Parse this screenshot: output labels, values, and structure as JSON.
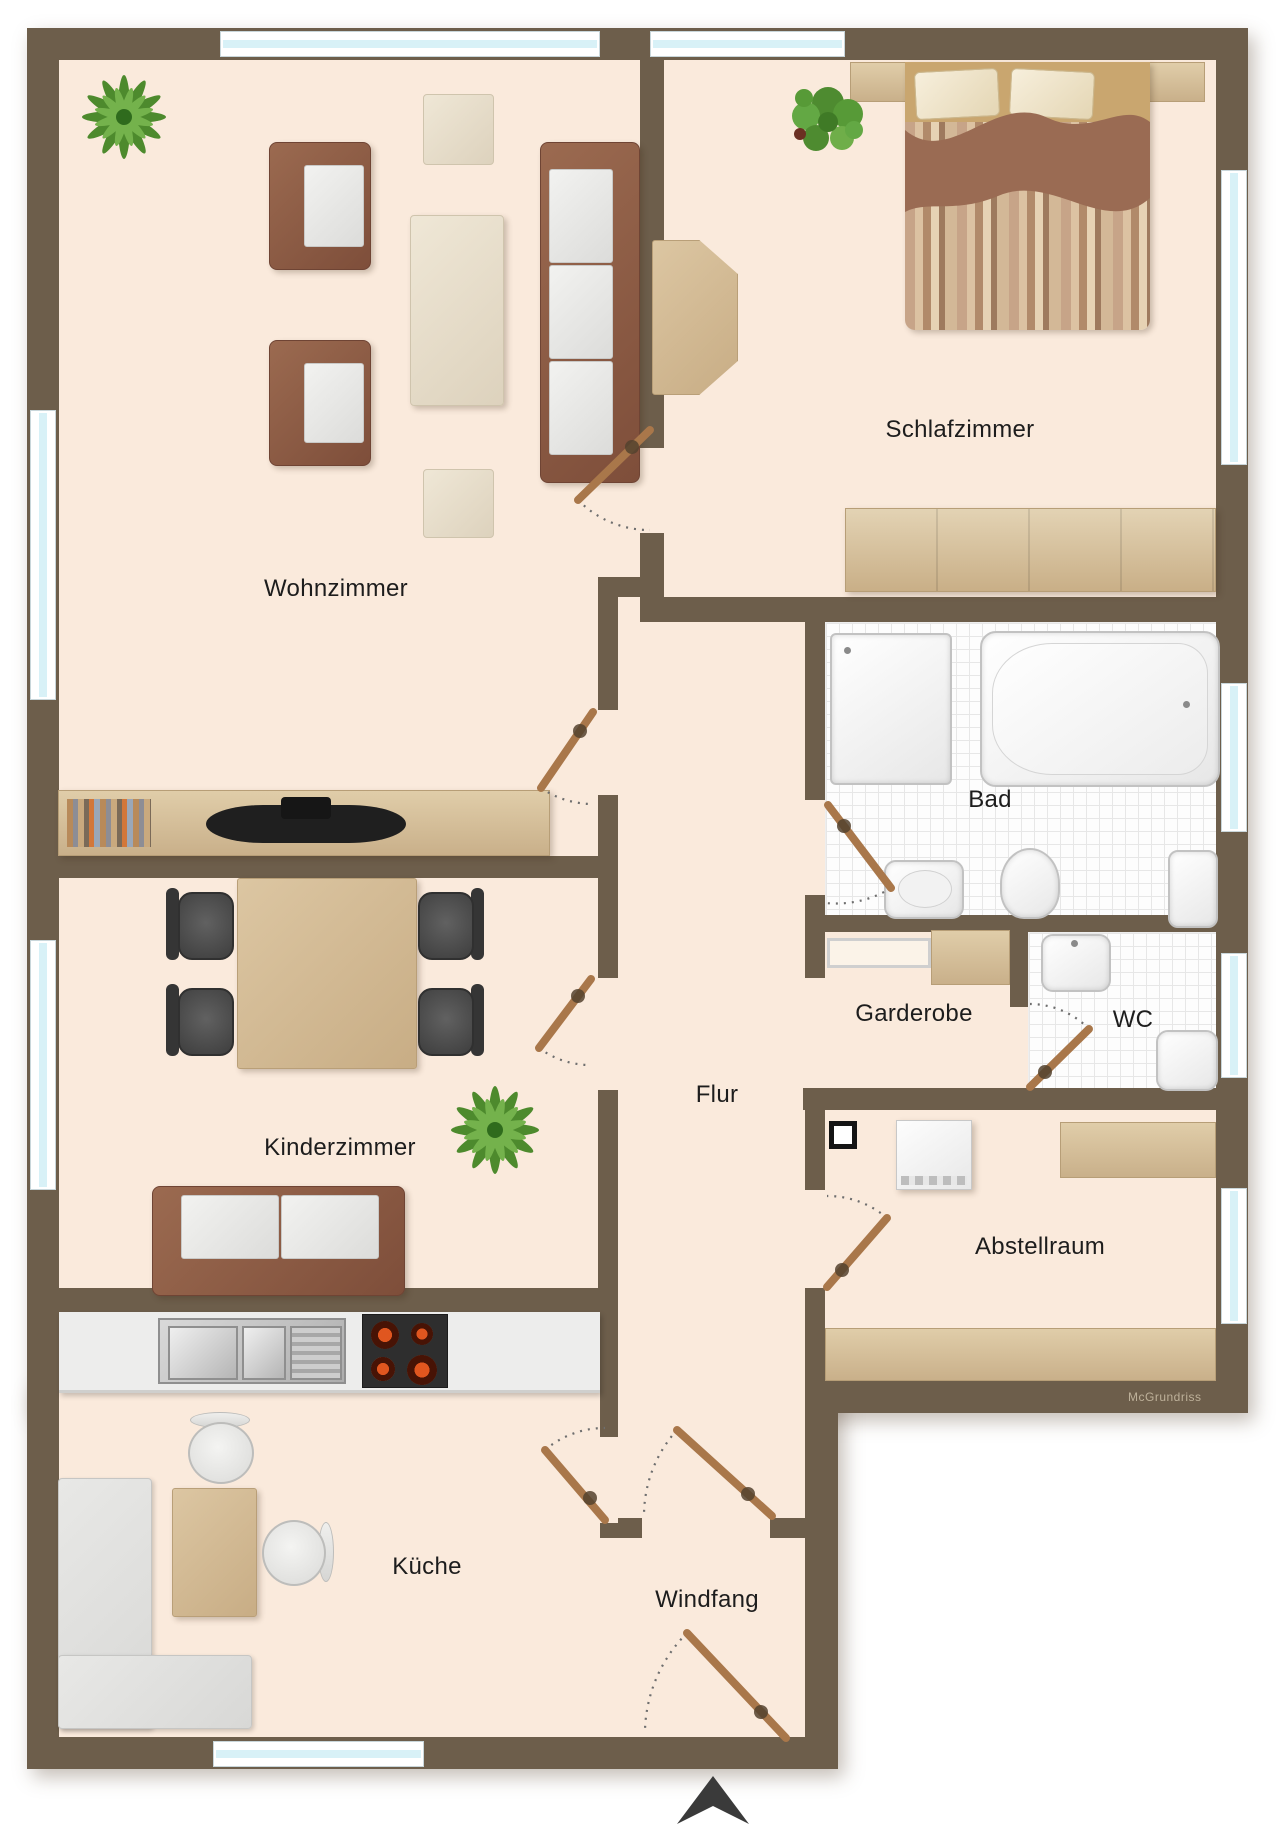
{
  "title": "Wohnungsgrundriss",
  "watermark": "McGrundriss",
  "rooms": [
    {
      "name": "wohnzimmer",
      "label": "Wohnzimmer"
    },
    {
      "name": "schlafzimmer",
      "label": "Schlafzimmer"
    },
    {
      "name": "bad",
      "label": "Bad"
    },
    {
      "name": "garderobe",
      "label": "Garderobe"
    },
    {
      "name": "wc",
      "label": "WC"
    },
    {
      "name": "flur",
      "label": "Flur"
    },
    {
      "name": "kinderzimmer",
      "label": "Kinderzimmer"
    },
    {
      "name": "abstellraum",
      "label": "Abstellraum"
    },
    {
      "name": "kueche",
      "label": "Küche"
    },
    {
      "name": "windfang",
      "label": "Windfang"
    }
  ],
  "colors": {
    "wall": "#6d5e4b",
    "floor": "#faeadc",
    "window_glass": "#d8f1f7",
    "door_leaf": "#a9774a",
    "tile": "#fdfdfd",
    "wood": "#d2b78f",
    "sofa_frame": "#8a5a44",
    "plant_green": "#4d8a2d",
    "stove_burner": "#d94f1e",
    "north_arrow": "#3a3a3a"
  }
}
